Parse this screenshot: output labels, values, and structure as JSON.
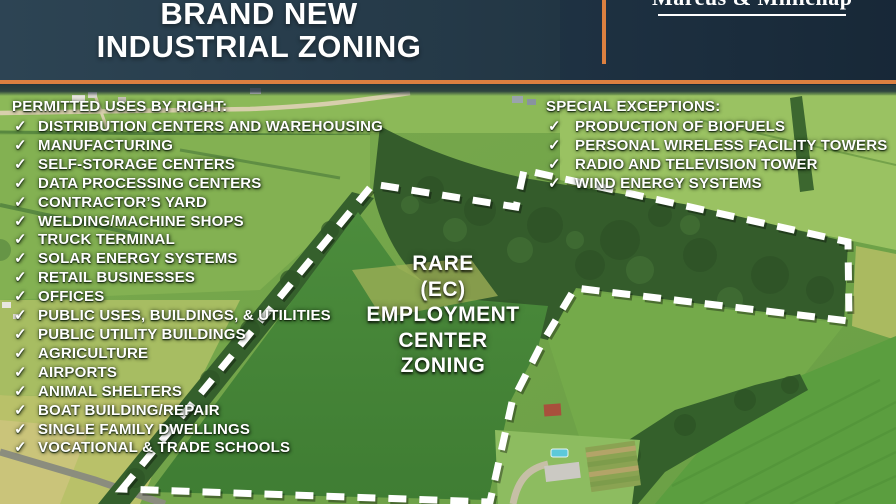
{
  "header": {
    "title_line1": "BRAND NEW",
    "title_line2": "INDUSTRIAL ZONING",
    "brand": "Marcus & Millichap"
  },
  "permitted_uses": {
    "heading": "PERMITTED USES BY RIGHT:",
    "items": [
      "DISTRIBUTION CENTERS AND WAREHOUSING",
      "MANUFACTURING",
      "SELF-STORAGE CENTERS",
      "DATA PROCESSING CENTERS",
      "CONTRACTOR’S YARD",
      "WELDING/MACHINE SHOPS",
      "TRUCK TERMINAL",
      "SOLAR ENERGY SYSTEMS",
      "RETAIL BUSINESSES",
      "OFFICES",
      "PUBLIC USES, BUILDINGS, & UTILITIES",
      "PUBLIC UTILITY BUILDINGS",
      "AGRICULTURE",
      "AIRPORTS",
      "ANIMAL SHELTERS",
      "BOAT BUILDING/REPAIR",
      "SINGLE FAMILY DWELLINGS",
      "VOCATIONAL & TRADE SCHOOLS"
    ]
  },
  "special_exceptions": {
    "heading": "SPECIAL EXCEPTIONS:",
    "items": [
      "PRODUCTION OF BIOFUELS",
      "PERSONAL WIRELESS FACILITY TOWERS",
      "RADIO AND TELEVISION TOWER",
      "WIND ENERGY SYSTEMS"
    ]
  },
  "zoning_label": {
    "lines": [
      "RARE",
      "(EC)",
      "EMPLOYMENT",
      "CENTER",
      "ZONING"
    ]
  },
  "glyphs": {
    "check": "✓"
  },
  "colors": {
    "accent_orange": "#DC8040",
    "header_navy": "#24405A",
    "boundary_white": "#FFFFFF"
  },
  "boundary": {
    "points": "122,489 373,184 516,207 524,170 848,242 849,321 575,288 541,345 512,402 490,502"
  }
}
